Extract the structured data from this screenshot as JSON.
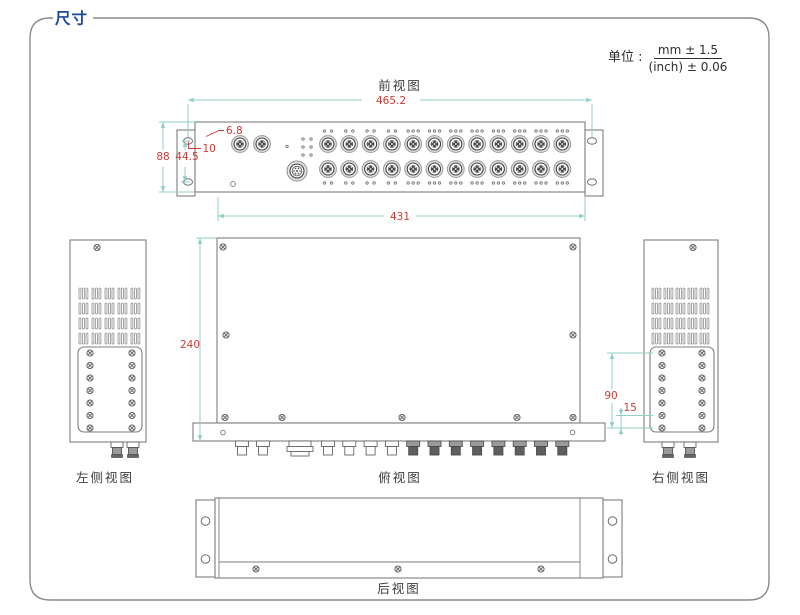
{
  "header": {
    "title": "尺寸"
  },
  "unit": {
    "label": "单位 :",
    "mm": "mm ± 1.5",
    "inch": "(inch) ± 0.06"
  },
  "views": {
    "front": {
      "label": "前视图"
    },
    "left": {
      "label": "左侧视图"
    },
    "top": {
      "label": "俯视图"
    },
    "right": {
      "label": "右侧视图"
    },
    "rear": {
      "label": "后视图"
    }
  },
  "dims": {
    "overall_width": "465.2",
    "ear_hole_offset": "6.8",
    "ear_hole_pitch": "10",
    "panel_height": "88",
    "panel_hole_spacing": "44.5",
    "body_width": "431",
    "depth": "240",
    "side_screw_span": "90",
    "side_screw_gap": "15"
  },
  "colors": {
    "accent_blue": "#1b4a9c",
    "dim_line": "#8ecfc6",
    "dim_text": "#cf3a32",
    "outline": "#7d7d7d",
    "label": "#3c3c3c",
    "border": "#8a8a8a"
  }
}
